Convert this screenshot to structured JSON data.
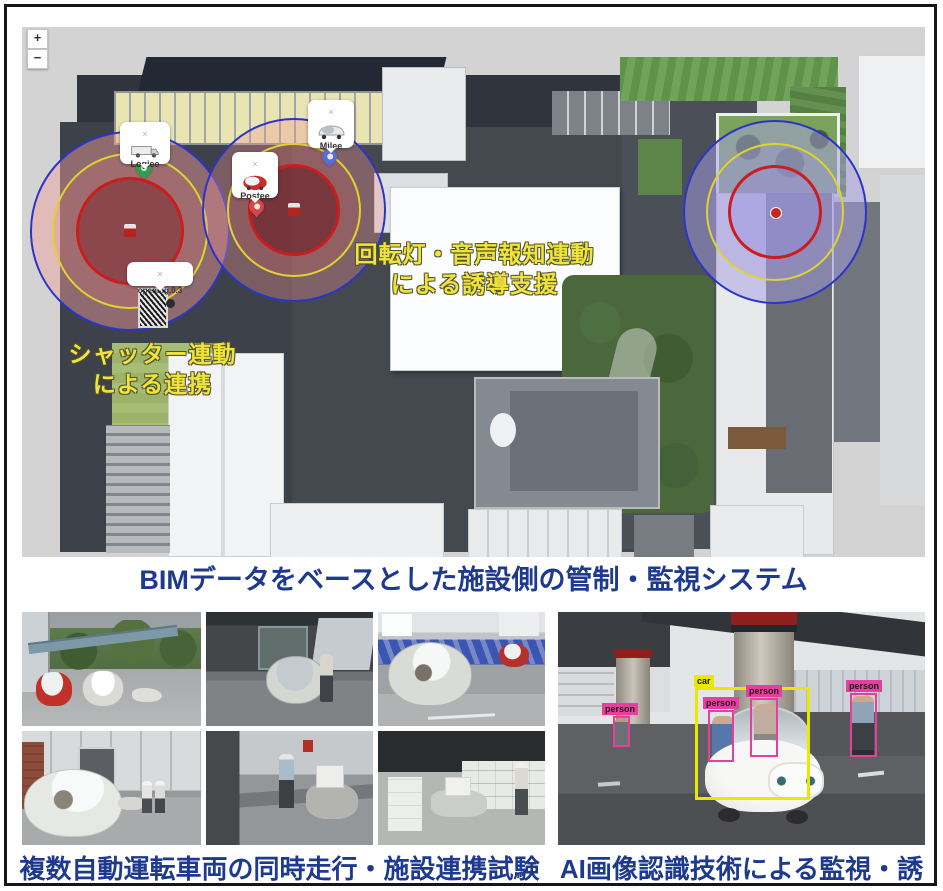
{
  "captions": {
    "bim": "BIMデータをベースとした施設側の管制・監視システム",
    "grid": "複数自動運転車両の同時走行・施設連携試験",
    "ai": "AI画像認識技術による監視・誘導",
    "color": "#1d3a8f"
  },
  "map": {
    "zoom_in_label": "+",
    "zoom_out_label": "−",
    "notes": {
      "beacon_line1": "回転灯・音声報知連動",
      "beacon_line2": "による誘導支援",
      "shutter_line1": "シャッター連動",
      "shutter_line2": "による連携",
      "text_color": "#f0e43a"
    },
    "markers": [
      {
        "label": "Logiee",
        "close": "×",
        "icon": "truck-icon",
        "pin_color": "#2ea04c"
      },
      {
        "label": "Postee",
        "close": "×",
        "icon": "red-pod-icon",
        "pin_color": "#d24848"
      },
      {
        "label": "Milee",
        "close": "×",
        "icon": "white-pod-icon",
        "pin_color": "#5a6cd2"
      },
      {
        "label": "opening,0.3",
        "close": "×",
        "icon": "shutter-icon"
      }
    ],
    "zone_ring_colors": {
      "outer": "#2a35c8",
      "middle": "#ddd42e",
      "inner": "#cc1d1d"
    },
    "zone_fill_colors": {
      "left_pink": "rgba(243,158,158,0.45)",
      "center_red": "rgba(95,14,20,0.5)",
      "right_purple": "rgba(168,158,228,0.5)"
    }
  },
  "ai": {
    "detections": [
      {
        "label": "car",
        "color": "#e9e900"
      },
      {
        "label": "person",
        "color": "#e83e9e"
      },
      {
        "label": "person",
        "color": "#e83e9e"
      },
      {
        "label": "person",
        "color": "#e83e9e"
      },
      {
        "label": "person",
        "color": "#e83e9e"
      }
    ]
  }
}
